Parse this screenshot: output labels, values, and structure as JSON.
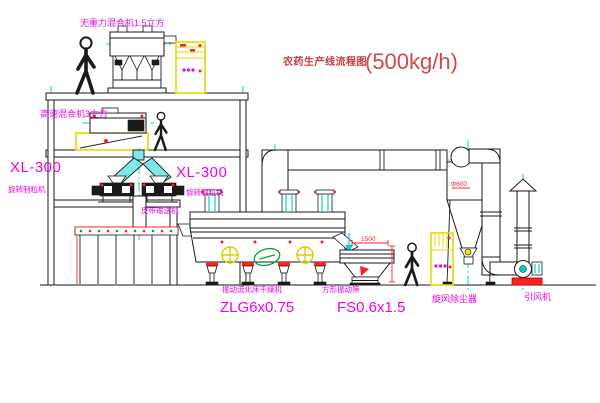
{
  "title": {
    "text": "农药生产线流程图",
    "capacity": "(500kg/h)"
  },
  "labels": {
    "gravity_mixer": "无重力混合机1.5立方",
    "high_speed_mixer": "高速混合机3立方",
    "granulator_left_model": "XL-300",
    "granulator_left_name": "旋转制粒机",
    "granulator_center_model": "XL-300",
    "granulator_center_name": "旋转制粒机",
    "belt_conveyor": "皮带输送机",
    "dryer_name": "振动流化床干燥机",
    "dryer_model": "ZLG6x0.75",
    "sieve_name": "方形振动筛",
    "sieve_model": "FS0.6x1.5",
    "cyclone": "旋风除尘器",
    "fan": "引风机"
  },
  "dims": {
    "sieve_width": "1500",
    "cyclone_dia": "Φ600"
  },
  "colors": {
    "label_magenta": "#ee00ee",
    "title_red": "#c23b3b",
    "line_black": "#1a1a1a",
    "centerline_cyan": "#00d5d5",
    "cabinet_yellow": "#e8d800",
    "accent_red": "#ff2020",
    "stamp_green": "#00a33e"
  }
}
